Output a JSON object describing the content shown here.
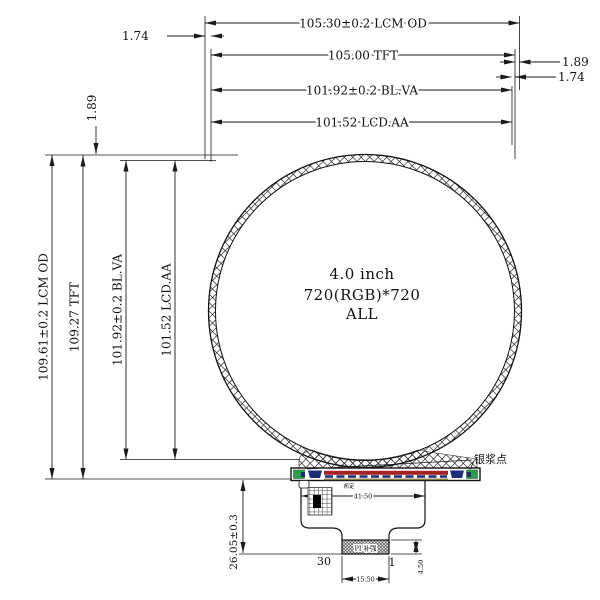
{
  "ann": {
    "top": [
      "105.30±0.2 LCM OD",
      "105.00 TFT",
      "101.92±0.2 BL.VA",
      "101.52 LCD.AA"
    ],
    "left": [
      "109.61±0.2 LCM OD",
      "109.27 TFT",
      "101.92±0.2 BL.VA",
      "101.52 LCD.AA"
    ],
    "edge_top_left": "1.74",
    "edge_left": "1.89",
    "edge_right": [
      "1.89",
      "1.74"
    ],
    "center": [
      "4.0 inch",
      "720(RGB)*720",
      "ALL"
    ],
    "silver_paste": "银浆点",
    "bonding": "邦定",
    "fpc_width": "41.50",
    "fpc_height": "26.05±0.3",
    "pin_left": "30",
    "pin_right": "1",
    "conn_width": "15.50",
    "conn_height": "4.50",
    "stiffener": "PI 补强"
  },
  "colors": {
    "pad_green": "#2f9e4b",
    "mark_navy": "#1c2e7a",
    "strip_red": "#a32424",
    "strip_olive": "#8b7d4a",
    "center_text": "#4f5b72"
  }
}
